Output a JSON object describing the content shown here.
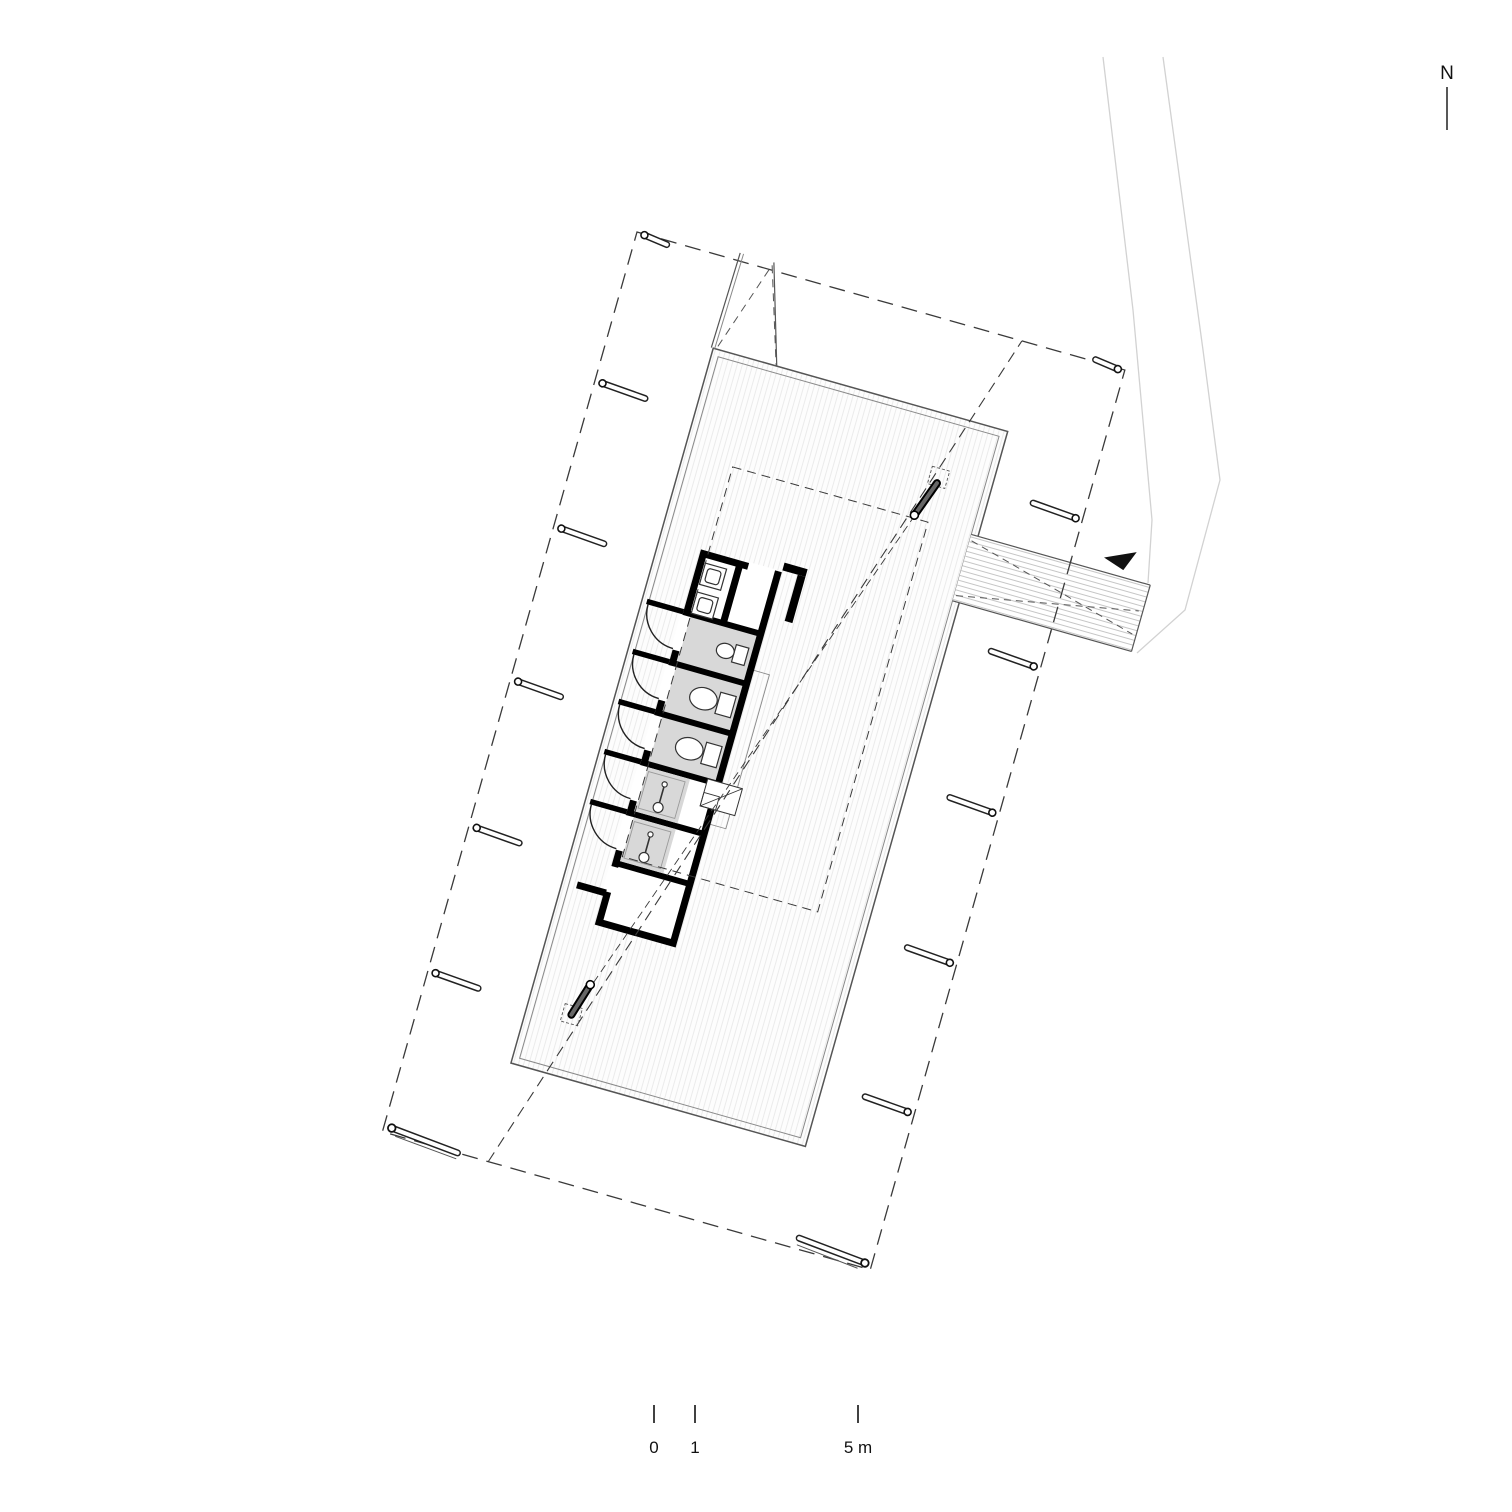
{
  "north_arrow": {
    "label": "N"
  },
  "scale_bar": {
    "labels": {
      "zero": "0",
      "one": "1",
      "five": "5 m"
    }
  },
  "colors": {
    "background": "#ffffff",
    "line_dark": "#1a1a1a",
    "wall_black": "#000000",
    "stall_floor_gray": "#d8d8d8",
    "deck_fill": "#fdfdfd",
    "deck_hatch": "#ebebeb",
    "bridge_hatch": "#c6c6c6",
    "dashed_line": "#3a3a3a",
    "mast_fill": "#666666",
    "footpath_gray": "#d2d2d2",
    "fixture_line": "#333333"
  },
  "plan_elements": {
    "site_rotation_deg": 15.8,
    "stalls": {
      "accessible_wc": 1,
      "wc": 2,
      "shower": 2
    },
    "sink_count": 2,
    "anchors_left": 7,
    "anchors_right": 7,
    "mast_count": 2,
    "door_arc_count": 5
  }
}
